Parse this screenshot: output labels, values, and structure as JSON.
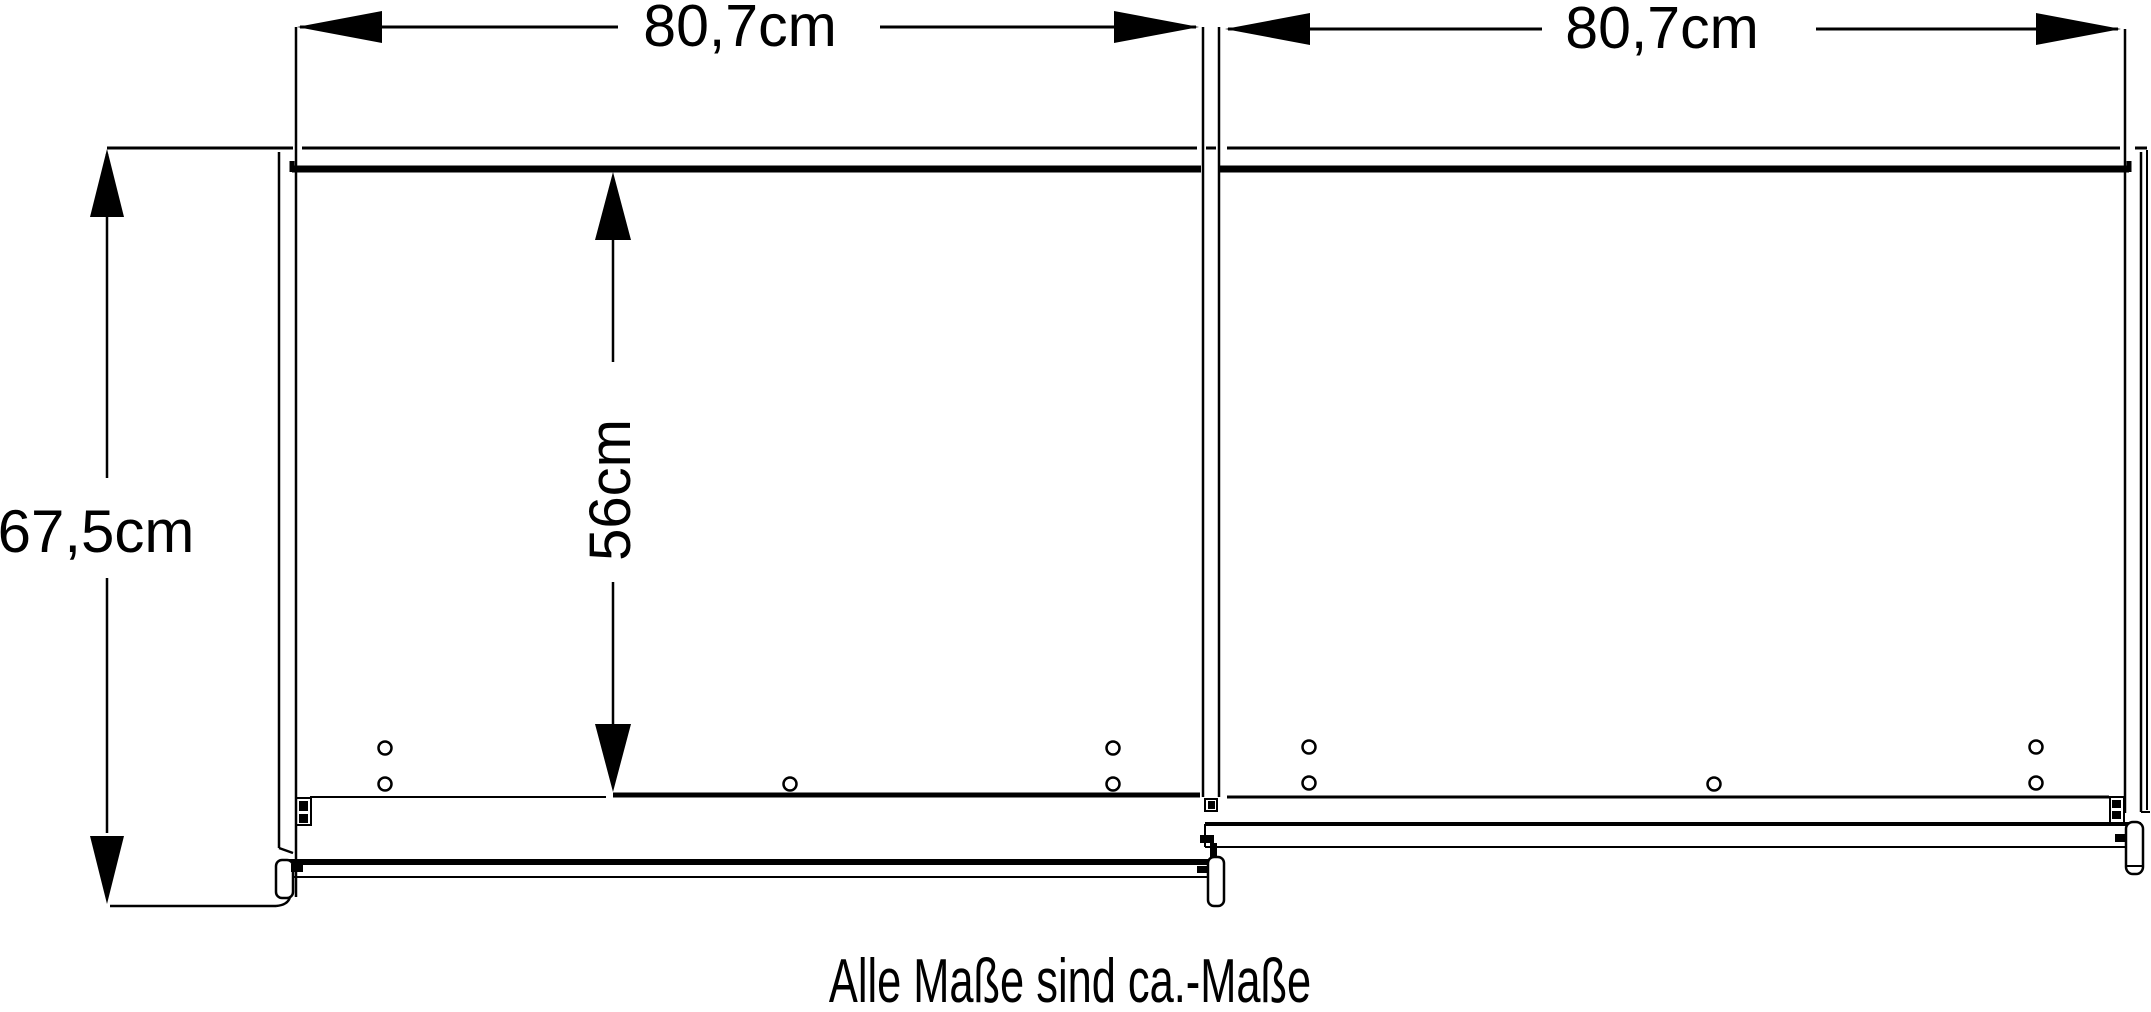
{
  "diagram": {
    "caption": "Alle Maße sind ca.-Maße",
    "dimensions": {
      "door_left_width": {
        "label": "80,7cm"
      },
      "door_right_width": {
        "label": "80,7cm"
      },
      "total_height": {
        "label": "67,5cm"
      },
      "interior_height": {
        "label": "56cm"
      }
    },
    "colors": {
      "ink": "#000000",
      "background": "#ffffff"
    }
  }
}
